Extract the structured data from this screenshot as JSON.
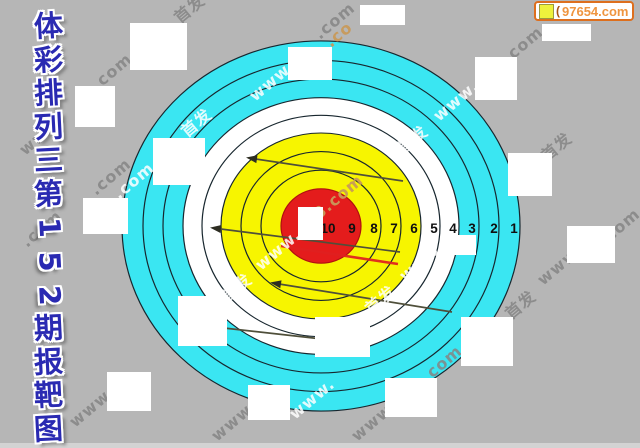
{
  "page": {
    "background": "#b6b6b6",
    "bottom_strip_color": "#d3d3d3"
  },
  "title": {
    "text": "体彩排列三第152期报靶图",
    "chars": [
      "体",
      "彩",
      "排",
      "列",
      "三",
      "第",
      "1",
      "5",
      "2",
      "期",
      "报",
      "靶",
      "图"
    ],
    "rotated_indices": [
      6,
      7,
      8
    ],
    "color": "#2a2ab2"
  },
  "badge": {
    "site": "97654.com",
    "partial_char": "(",
    "border_color": "#dd6f1e",
    "text_color": "#ef9540",
    "icon_color": "#eef23c"
  },
  "target": {
    "cx": 321,
    "cy": 226,
    "y_scale": 0.93,
    "outline_color": "#17262e",
    "colors": {
      "outer_zone": "#3ae6f2",
      "mid_zone": "#ffffff",
      "inner_zone": "#f7f500",
      "bull": "#e41c1c"
    },
    "rings": [
      {
        "r": 199,
        "fill": "#3ae6f2"
      },
      {
        "r": 178,
        "fill": "none"
      },
      {
        "r": 158,
        "fill": "none"
      },
      {
        "r": 138,
        "fill": "#ffffff"
      },
      {
        "r": 119,
        "fill": "none"
      },
      {
        "r": 100,
        "fill": "#f7f500"
      },
      {
        "r": 80,
        "fill": "none"
      },
      {
        "r": 60,
        "fill": "none"
      },
      {
        "r": 40,
        "fill": "#e41c1c",
        "stroke": "#b01010"
      }
    ],
    "ring_numbers": {
      "labels": [
        "10",
        "9",
        "8",
        "7",
        "6",
        "5",
        "4",
        "3",
        "2",
        "1"
      ],
      "x": [
        328,
        352,
        374,
        394,
        414,
        434,
        453,
        472,
        494,
        514
      ],
      "baseline_y": 233,
      "color": "#101010"
    }
  },
  "arrows": {
    "color": "#4f4f3a",
    "head_color": "#2d2d22",
    "lines": [
      {
        "x1": 249,
        "y1": 158,
        "x2": 403,
        "y2": 181
      },
      {
        "x1": 213,
        "y1": 228,
        "x2": 400,
        "y2": 252
      },
      {
        "x1": 273,
        "y1": 283,
        "x2": 452,
        "y2": 312
      },
      {
        "x1": 206,
        "y1": 326,
        "x2": 340,
        "y2": 341
      }
    ]
  },
  "red_line": {
    "x1": 281,
    "y1": 246,
    "x2": 398,
    "y2": 264,
    "color": "#e02020"
  },
  "covers": [
    [
      130,
      23,
      57,
      47
    ],
    [
      288,
      47,
      44,
      33
    ],
    [
      360,
      5,
      45,
      20
    ],
    [
      542,
      24,
      49,
      17
    ],
    [
      75,
      86,
      40,
      41
    ],
    [
      475,
      57,
      42,
      43
    ],
    [
      153,
      138,
      52,
      47
    ],
    [
      508,
      153,
      44,
      43
    ],
    [
      83,
      198,
      45,
      36
    ],
    [
      567,
      226,
      48,
      37
    ],
    [
      178,
      296,
      49,
      50
    ],
    [
      315,
      317,
      55,
      40
    ],
    [
      461,
      317,
      52,
      49
    ],
    [
      107,
      372,
      44,
      39
    ],
    [
      248,
      385,
      42,
      35
    ],
    [
      385,
      378,
      52,
      39
    ],
    [
      453,
      235,
      23,
      20
    ],
    [
      298,
      207,
      25,
      33
    ]
  ],
  "watermarks": {
    "angle": -40,
    "items": [
      {
        "t": "首发",
        "x": 180,
        "y": 24,
        "c": "gray"
      },
      {
        "t": ".com",
        "x": 320,
        "y": 40,
        "c": "gray"
      },
      {
        "t": ".com",
        "x": 508,
        "y": 64,
        "c": "gray"
      },
      {
        "t": "首发",
        "x": 547,
        "y": 162,
        "c": "gray"
      },
      {
        "t": ".com",
        "x": 605,
        "y": 246,
        "c": "gray"
      },
      {
        "t": "www.",
        "x": 543,
        "y": 286,
        "c": "gray"
      },
      {
        "t": "首发",
        "x": 511,
        "y": 320,
        "c": "gray"
      },
      {
        "t": ".com",
        "x": 97,
        "y": 91,
        "c": "gray"
      },
      {
        "t": "www",
        "x": 25,
        "y": 156,
        "c": "gray"
      },
      {
        "t": ".com",
        "x": 96,
        "y": 196,
        "c": "gray"
      },
      {
        "t": ".com",
        "x": 27,
        "y": 248,
        "c": "gray"
      },
      {
        "t": "www.",
        "x": 75,
        "y": 428,
        "c": "gray"
      },
      {
        "t": "www.",
        "x": 217,
        "y": 442,
        "c": "gray"
      },
      {
        "t": "www.",
        "x": 357,
        "y": 442,
        "c": "gray"
      },
      {
        "t": ".com",
        "x": 427,
        "y": 383,
        "c": "gray"
      },
      {
        "t": "www.",
        "x": 255,
        "y": 102,
        "c": "white"
      },
      {
        "t": "首发",
        "x": 187,
        "y": 138,
        "c": "white"
      },
      {
        "t": "www.",
        "x": 439,
        "y": 122,
        "c": "white"
      },
      {
        "t": "首发",
        "x": 403,
        "y": 155,
        "c": "white"
      },
      {
        "t": ".com",
        "x": 119,
        "y": 200,
        "c": "white"
      },
      {
        "t": "www.",
        "x": 261,
        "y": 271,
        "c": "white"
      },
      {
        "t": "首发",
        "x": 227,
        "y": 303,
        "c": "white"
      },
      {
        "t": "www.",
        "x": 405,
        "y": 282,
        "c": "white"
      },
      {
        "t": "首发",
        "x": 371,
        "y": 315,
        "c": "white"
      },
      {
        "t": "www.",
        "x": 295,
        "y": 420,
        "c": "white"
      },
      {
        "t": "8.com",
        "x": 319,
        "y": 220,
        "c": "tan"
      },
      {
        "t": ".co",
        "x": 331,
        "y": 48,
        "c": "tan"
      }
    ]
  }
}
